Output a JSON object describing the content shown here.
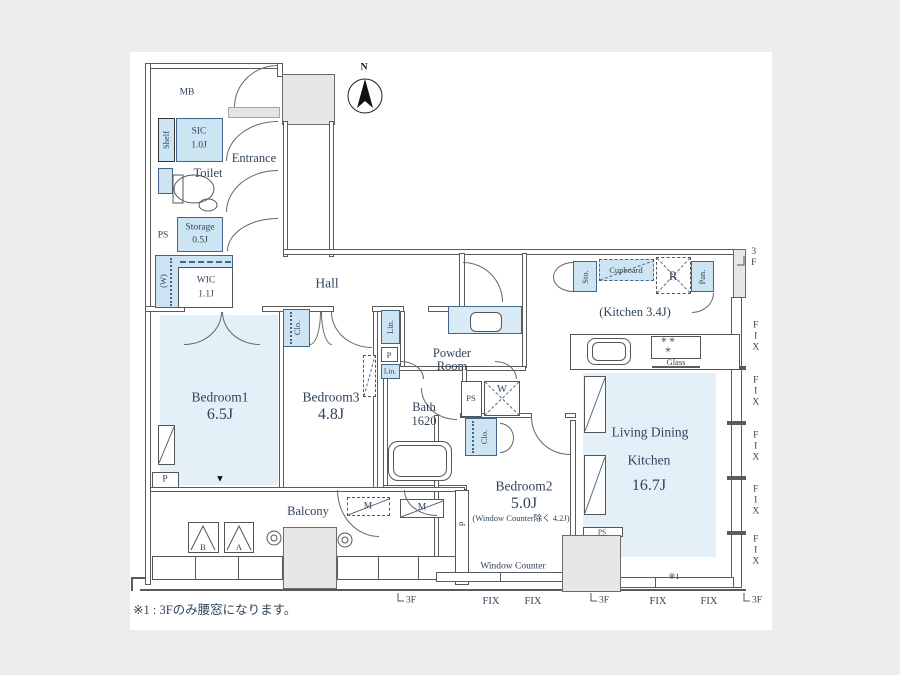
{
  "note": "※1 : 3Fのみ腰窓になります。",
  "compass": {
    "north": "N"
  },
  "rooms": {
    "mb": "MB",
    "entrance": "Entrance",
    "toilet": "Toilet",
    "hall": "Hall",
    "sic": {
      "name": "SIC",
      "area": "1.0J"
    },
    "shelf": "Shelf",
    "ps": "PS",
    "storage": {
      "name": "Storage",
      "area": "0.5J"
    },
    "wic": {
      "name": "WIC",
      "area": "1.1J",
      "w": "(W)"
    },
    "bedroom1": {
      "name": "Bedroom1",
      "area": "6.5J"
    },
    "bedroom3": {
      "name": "Bedroom3",
      "area": "4.8J"
    },
    "bedroom2": {
      "name": "Bedroom2",
      "area": "5.0J",
      "note": "(Window Counter除く 4.2J)"
    },
    "bath": {
      "name": "Bath",
      "size": "1620"
    },
    "powder": {
      "line1": "Powder",
      "line2": "Room"
    },
    "kitchen": "(Kitchen 3.4J)",
    "ldk": {
      "line1": "Living Dining",
      "line2": "Kitchen",
      "area": "16.7J"
    },
    "balcony": "Balcony",
    "window_counter": "Window Counter"
  },
  "fixtures": {
    "clo": "Clo.",
    "lin": "Lin.",
    "p": "P",
    "w": "W",
    "ps": "PS",
    "sto": "Sto.",
    "pan": "Pan.",
    "cupboard": "Cupboard",
    "fridge": "R",
    "glass": "Glass",
    "meter": "M",
    "hatch_a": "A",
    "hatch_b": "B"
  },
  "annotations": {
    "fix": "FIX",
    "floor3": "3F",
    "ref1": "※1"
  },
  "icons": {
    "burner_row": "✳ ✳",
    "burner_single": "✳",
    "triangle_marker": "▼"
  },
  "colors": {
    "fixture_blue": "#cde5f3",
    "room_blue": "#e4f0f8",
    "wall": "#5b5b5b",
    "bg": "#ececec"
  }
}
